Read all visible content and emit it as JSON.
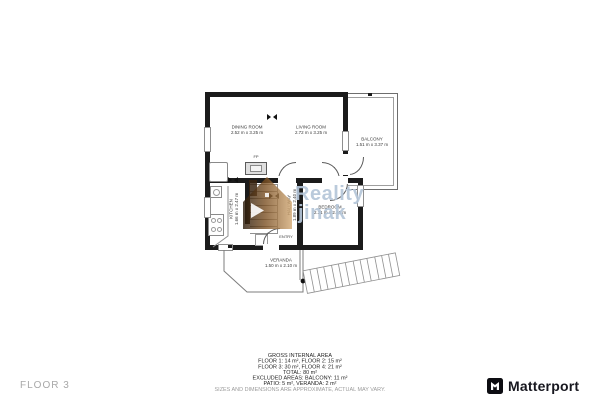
{
  "page": {
    "floor_label": "FLOOR 3"
  },
  "watermark": {
    "line1": "Reality",
    "line2": "jinak",
    "house_color": "#7a4f22",
    "text_color": "#b5c6d9"
  },
  "brand": {
    "name": "Matterport",
    "icon": "matterport-cube-icon",
    "text_color": "#17171f"
  },
  "rooms": {
    "dining": {
      "name": "DINING ROOM",
      "dims": "2.52 m x 3.25 m"
    },
    "living": {
      "name": "LIVING ROOM",
      "dims": "2.72 m x 3.25 m"
    },
    "balcony": {
      "name": "BALCONY",
      "dims": "1.51 m x 3.37 m"
    },
    "kitchen": {
      "name": "KITCHEN",
      "dims": "1.66 m x 2.47 m"
    },
    "hallway": {
      "name": "HALLWAY",
      "dims": "1.89 m x 2.40 m"
    },
    "bedroom": {
      "name": "BEDROOM",
      "dims": "2.31 m x 2.40 m"
    },
    "veranda": {
      "name": "VERANDA",
      "dims": "1.50 m x 2.10 m"
    },
    "entry": {
      "name": "ENTRY"
    },
    "fireplace": {
      "name": "FP"
    }
  },
  "area_summary": {
    "title": "GROSS INTERNAL AREA",
    "lines": [
      "FLOOR 1: 14 m², FLOOR 2: 15 m²",
      "FLOOR 3: 30 m², FLOOR 4: 21 m²",
      "TOTAL: 80 m²",
      "EXCLUDED AREAS: BALCONY: 11 m²",
      "PATIO: 5 m², VERANDA: 2 m²"
    ],
    "disclaimer": "SIZES AND DIMENSIONS ARE APPROXIMATE, ACTUAL MAY VARY."
  },
  "colors": {
    "wall": "#1b1b1b",
    "thin_line": "#8f8f8f"
  }
}
